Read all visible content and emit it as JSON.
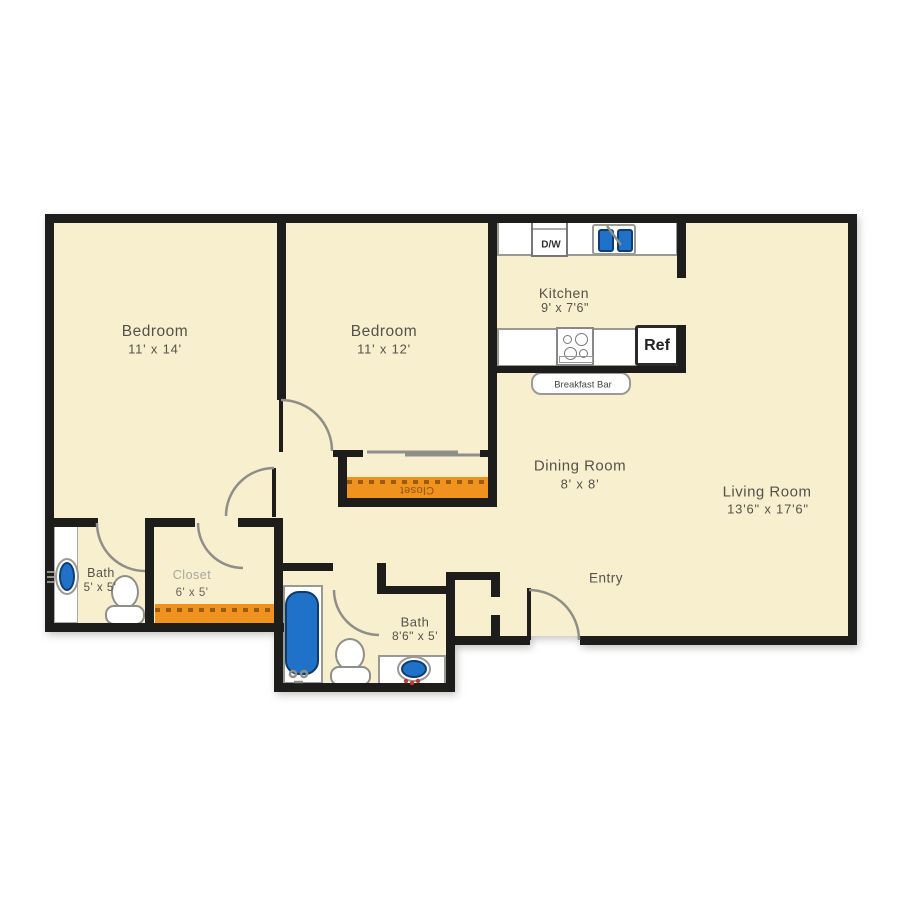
{
  "plan_title": "Two bedroom apartment floor plan",
  "colors": {
    "floor": "#f8efcf",
    "wall": "#1d1d1b",
    "closet_accent": "#f0921e",
    "fixture_blue": "#1f72c8",
    "line_gray": "#8f8f88",
    "label_text": "#55524a"
  },
  "rooms": {
    "bedroom1": {
      "name": "Bedroom",
      "dims": "11' x 14'"
    },
    "bedroom2": {
      "name": "Bedroom",
      "dims": "11' x 12'"
    },
    "kitchen": {
      "name": "Kitchen",
      "dims": "9' x 7'6\""
    },
    "dining_room": {
      "name": "Dining Room",
      "dims": "8' x 8'"
    },
    "living_room": {
      "name": "Living Room",
      "dims": "13'6\" x 17'6\""
    },
    "entry": {
      "name": "Entry"
    },
    "bath_1": {
      "name": "Bath",
      "dims": "5' x 5'"
    },
    "closet_1": {
      "name": "Closet",
      "dims": "6' x 5'"
    },
    "bath_2": {
      "name": "Bath",
      "dims": "8'6\" x 5'"
    },
    "bedroom2_closet": {
      "name": "Closet"
    }
  },
  "fixtures": {
    "dishwasher_label": "D/W",
    "refrigerator_label": "Ref",
    "breakfast_bar_label": "Breakfast Bar"
  }
}
